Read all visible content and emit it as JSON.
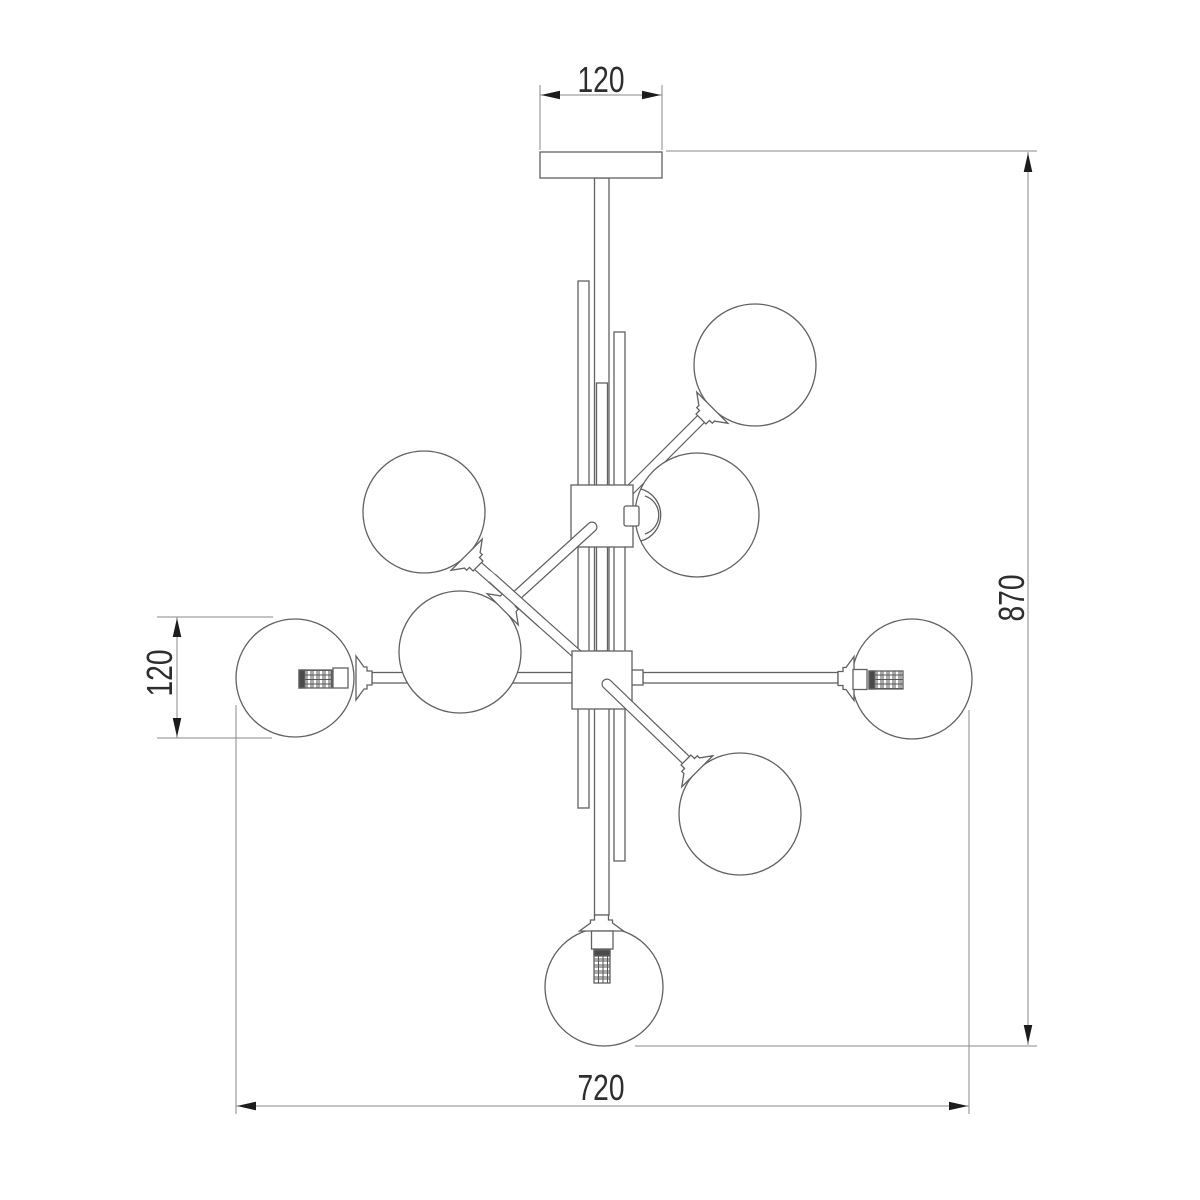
{
  "drawing": {
    "title": "chandelier-8-globe-technical-drawing",
    "line_color": "#616161",
    "dim_line_color": "#8a8a8a",
    "arrow_color": "#1c1c1c",
    "text_color": "#2e2e2e",
    "dimensions": {
      "mount_width": "120",
      "shade_diameter": "120",
      "overall_height": "870",
      "overall_width": "720"
    }
  }
}
